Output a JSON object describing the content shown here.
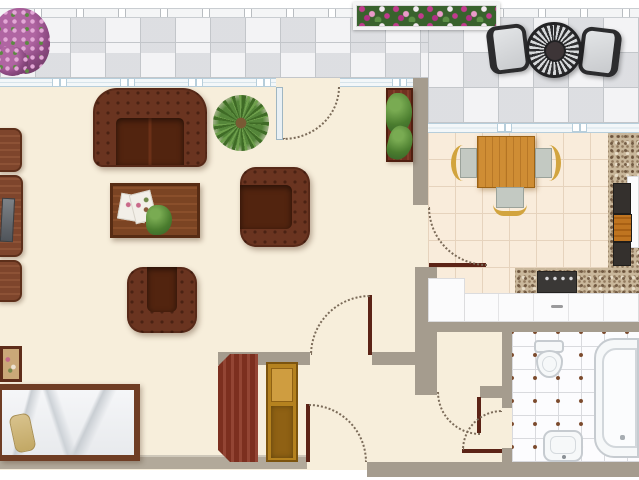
{
  "scene": {
    "kind": "apartment-floor-plan",
    "view": "top-down",
    "width_px": 639,
    "height_px": 480
  },
  "rooms": [
    {
      "id": "terrace",
      "features": [
        "paved-gray-tiles",
        "railing",
        "purple-flower-bush",
        "flower-planter-box",
        "ornate-round-patio-table",
        "two-patio-chairs"
      ]
    },
    {
      "id": "living-room",
      "features": [
        "tufted-brown-sofa",
        "two-tufted-armchairs",
        "wood-coffee-table",
        "magazines",
        "potted-palm",
        "tv-wall-unit",
        "plant-cabinet",
        "single-bed",
        "picture-tray"
      ]
    },
    {
      "id": "closet",
      "features": [
        "dark-red-wardrobe",
        "open-golden-cabinet"
      ]
    },
    {
      "id": "kitchen",
      "features": [
        "oak-dining-table",
        "three-chairs",
        "granite-counter",
        "stove-cooktop",
        "white-base-cabinets",
        "fridge"
      ]
    },
    {
      "id": "hallway",
      "features": [
        "five-door-swing-arcs"
      ]
    },
    {
      "id": "bathroom",
      "features": [
        "toilet",
        "washbasin",
        "bathtub",
        "white-mosaic-tiles"
      ]
    }
  ],
  "palette": {
    "floor_cream": "#f7eedb",
    "terrace_tile": "#e6e7ea",
    "terrace_line": "#c3c6ca",
    "railing": "#f4f5f6",
    "railing_line": "#c9cdd1",
    "window_band": "#f3f7f9",
    "window_line": "#b7cedb",
    "wall": "#a59c8e",
    "wall_bottom_left": "#b2a99a",
    "door_leaf": "#5c2316",
    "arc_dot": "#7b6b59",
    "sofa_dark": "#6a3420",
    "sofa_seat": "#52240f",
    "gold_cabinet": "#b5821f",
    "chair_gold": "#d2a43e",
    "chair_seat": "#c3c9c2",
    "kitchen_tile": "#f9ecdb",
    "kitchen_tile_line": "#e6d3bd",
    "granite": "#c9b79b",
    "bath_tile_line": "#d9dade",
    "bath_dot": "#7b4a2c",
    "fixture_line": "#c6cbd0",
    "flower_magenta": "#c13b8d",
    "flower_pink": "#ea9ac9",
    "flower_white": "#f3e9f0",
    "patio_dark": "#2e2e30",
    "patio_light": "#d7d9db",
    "counter_white": "#fbfbfc"
  }
}
